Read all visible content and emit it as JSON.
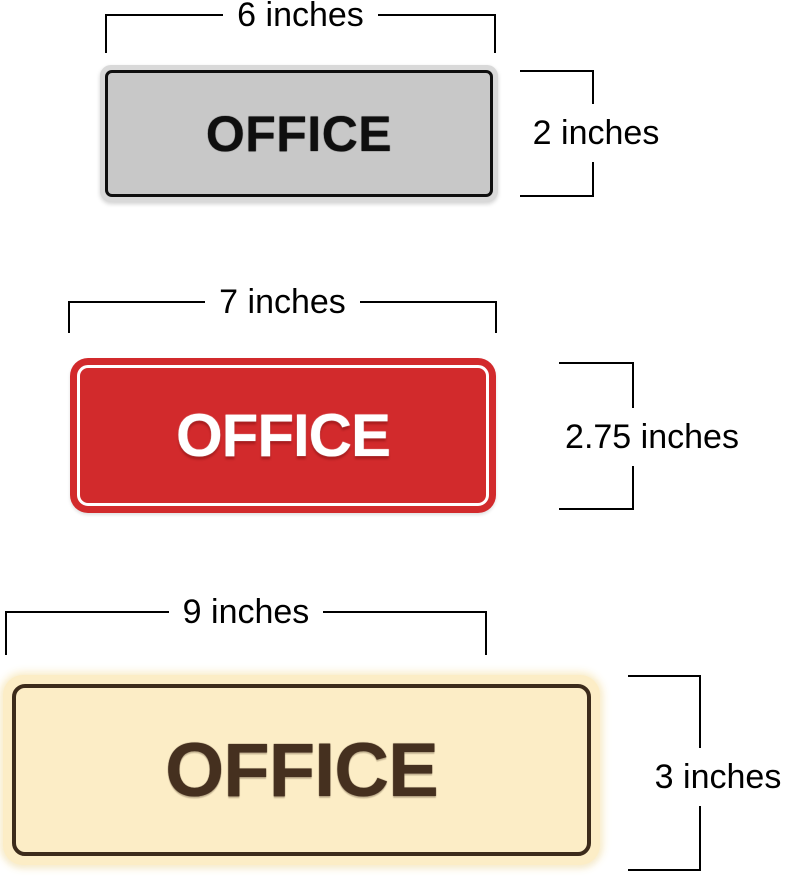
{
  "page": {
    "background": "#ffffff",
    "dimension_line_color": "#000000"
  },
  "signs": [
    {
      "name": "small-sign",
      "label": "OFFICE",
      "width_label": "6 inches",
      "height_label": "2 inches",
      "colors": {
        "background": "#c8c8c8",
        "rim": "#d9d9d9",
        "border": "#0f0f0f",
        "text": "#0f0f0f"
      }
    },
    {
      "name": "medium-sign",
      "label": "OFFICE",
      "width_label": "7 inches",
      "height_label": "2.75 inches",
      "colors": {
        "background": "#d22a2c",
        "border": "#ffffff",
        "text": "#ffffff"
      }
    },
    {
      "name": "large-sign",
      "label": "OFFICE",
      "width_label": "9 inches",
      "height_label": "3 inches",
      "colors": {
        "background": "#fcedc6",
        "border": "#3c2b1b",
        "text": "#45301f"
      }
    }
  ]
}
